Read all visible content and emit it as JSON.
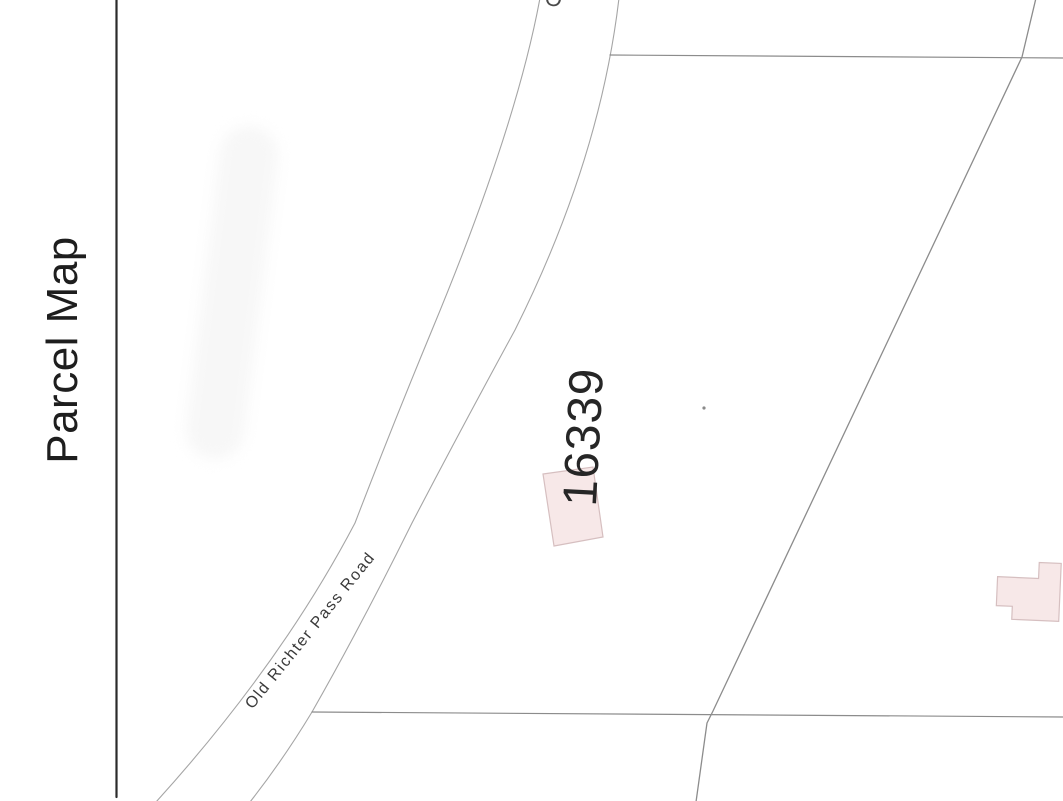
{
  "title": "Parcel Map",
  "map": {
    "parcel_number": "16339",
    "road_name": "Old Richter Pass Road",
    "top_edge_partial_label": "O",
    "colors": {
      "background": "#ffffff",
      "frame_line": "#2b2b2b",
      "parcel_line": "#8c8c8c",
      "road_line": "#a5a5a5",
      "building_fill": "#f7e8e8",
      "building_stroke": "#d6bfc0",
      "parcel_label_text": "#262626",
      "road_label_text": "#3a3a3a",
      "title_text": "#1e1e1e"
    }
  }
}
